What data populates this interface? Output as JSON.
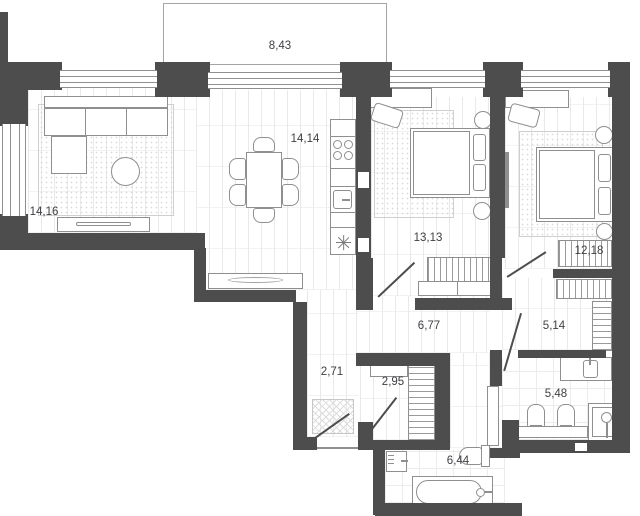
{
  "plan": {
    "type": "apartment-floor-plan",
    "rooms": [
      {
        "name": "balcony",
        "area": "8,43"
      },
      {
        "name": "living-room",
        "area": "14,16"
      },
      {
        "name": "kitchen-dining-room",
        "area": "14,14"
      },
      {
        "name": "bedroom-1",
        "area": "13,13"
      },
      {
        "name": "bedroom-2",
        "area": "12,18"
      },
      {
        "name": "hallway",
        "area": "6,77"
      },
      {
        "name": "wardrobe",
        "area": "5,14"
      },
      {
        "name": "entry-hall",
        "area": "2,71"
      },
      {
        "name": "closet",
        "area": "2,95"
      },
      {
        "name": "bathroom",
        "area": "5,48"
      },
      {
        "name": "bathroom-2",
        "area": "6,44"
      }
    ],
    "colors": {
      "wall": "#4d4d4d",
      "floor_line": "#e9e9e9",
      "furniture_line": "#8f8f8f",
      "label_text": "#3f3f44",
      "background": "#ffffff"
    }
  }
}
